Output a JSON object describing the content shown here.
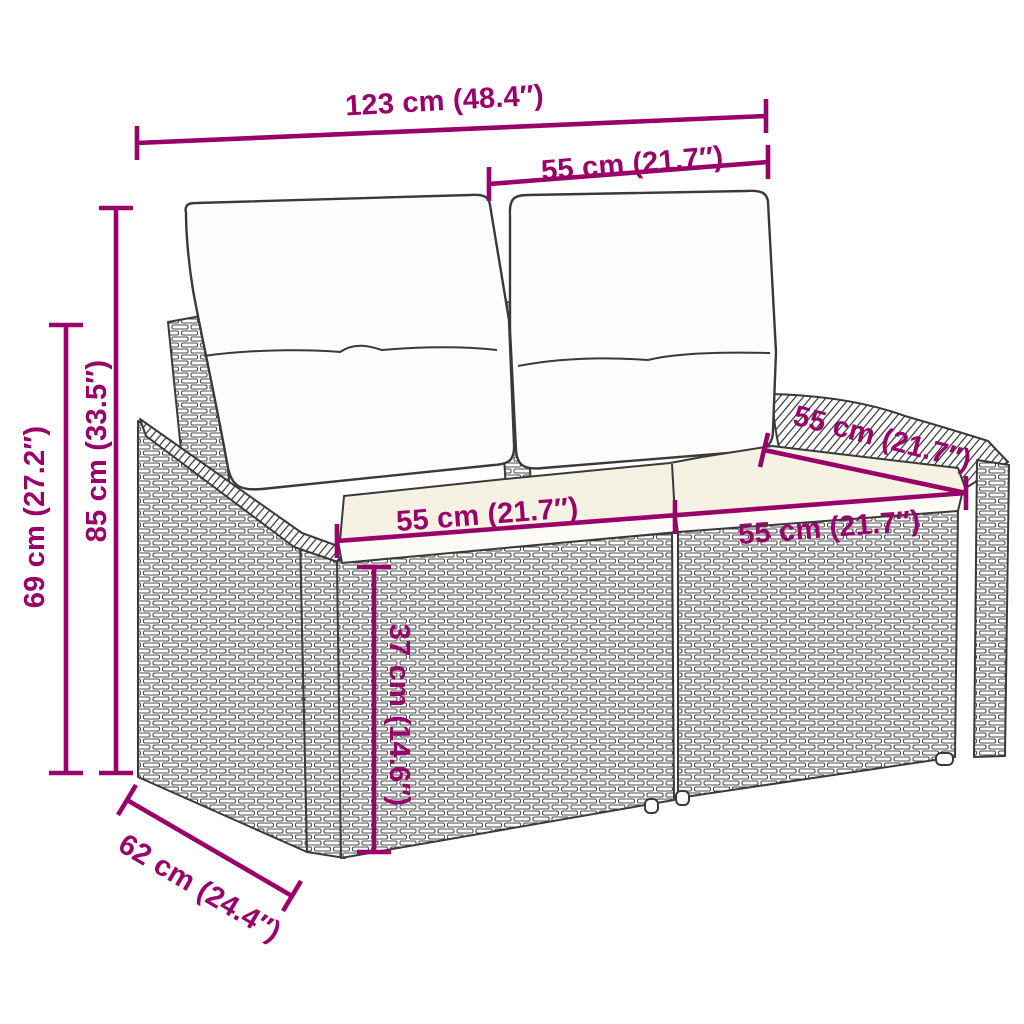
{
  "colors": {
    "dimension_annotation": "#9A0069",
    "line_art": "#3A3A3A",
    "seat_cushion_fill": "#F5F2E3",
    "pillow_fill": "#FDFDFC",
    "background": "#FFFFFF"
  },
  "dimensions": {
    "overall_width": "123 cm (48.4″)",
    "backrest_width": "55 cm (21.7″)",
    "overall_height": "85 cm (33.5″)",
    "armrest_height": "69 cm (27.2″)",
    "seat_width_left": "55 cm (21.7″)",
    "seat_width_right": "55 cm (21.7″)",
    "seat_depth": "55 cm (21.7″)",
    "seat_height": "37 cm (14.6″)",
    "overall_depth": "62 cm (24.4″)"
  }
}
